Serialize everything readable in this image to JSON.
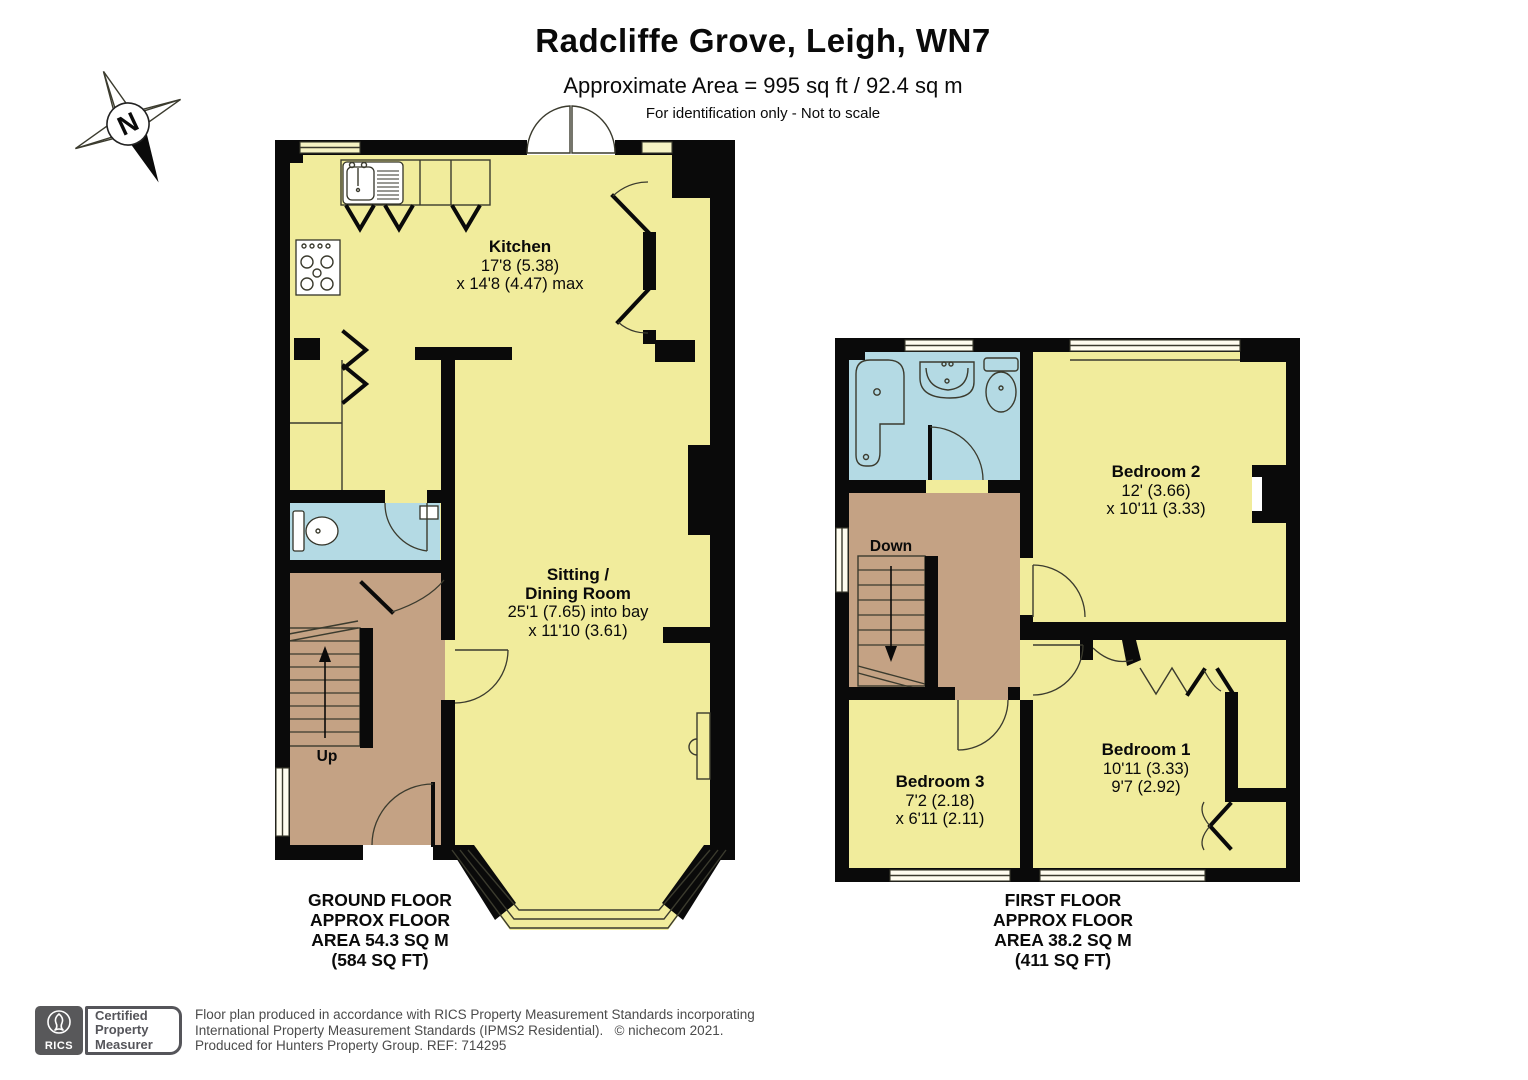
{
  "header": {
    "title": "Radcliffe Grove, Leigh, WN7",
    "approx_area": "Approximate Area = 995 sq ft / 92.4 sq m",
    "disclaimer": "For identification only - Not to scale"
  },
  "compass": {
    "north_label": "N"
  },
  "ground_floor": {
    "caption": [
      "GROUND FLOOR",
      "APPROX FLOOR",
      "AREA 54.3 SQ M",
      "(584 SQ FT)"
    ],
    "kitchen": {
      "name": "Kitchen",
      "dim1": "17'8 (5.38)",
      "dim2": "x 14'8 (4.47) max"
    },
    "sitting_dining": {
      "name1": "Sitting /",
      "name2": "Dining Room",
      "dim1": "25'1 (7.65) into bay",
      "dim2": "x 11'10 (3.61)"
    },
    "stairs_label": "Up"
  },
  "first_floor": {
    "caption": [
      "FIRST FLOOR",
      "APPROX FLOOR",
      "AREA 38.2 SQ M",
      "(411 SQ FT)"
    ],
    "bedroom1": {
      "name": "Bedroom 1",
      "dim1": "10'11 (3.33)",
      "dim2": "9'7 (2.92)"
    },
    "bedroom2": {
      "name": "Bedroom 2",
      "dim1": "12' (3.66)",
      "dim2": "x 10'11 (3.33)"
    },
    "bedroom3": {
      "name": "Bedroom 3",
      "dim1": "7'2 (2.18)",
      "dim2": "x 6'11 (2.11)"
    },
    "stairs_label": "Down"
  },
  "footer": {
    "rics_wordmark": "RICS",
    "badge_line1": "Certified",
    "badge_line2": "Property",
    "badge_line3": "Measurer",
    "line1": "Floor plan produced in accordance with RICS Property Measurement Standards incorporating",
    "line2": "International Property Measurement Standards (IPMS2 Residential).   © nichecom 2021.",
    "line3": "Produced for Hunters Property Group. REF: 714295"
  },
  "colors": {
    "room_fill": "#F1EC9C",
    "hall_fill": "#C4A284",
    "wet_room_fill": "#B4DAE4",
    "wall": "#0A0A0A",
    "rics_gray": "#58585A"
  }
}
